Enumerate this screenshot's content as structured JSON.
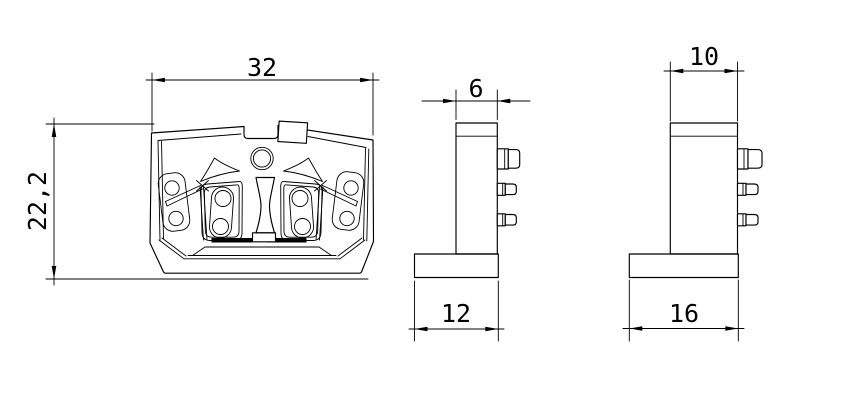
{
  "drawing_type": "engineering-three-view-drawing",
  "colors": {
    "ink": "#000000",
    "paper": "#ffffff"
  },
  "views": {
    "front": {
      "width": "32",
      "height": "22,2"
    },
    "side": {
      "top_width": "6",
      "base_width": "12"
    },
    "end": {
      "top_width": "10",
      "base_width": "16"
    }
  }
}
